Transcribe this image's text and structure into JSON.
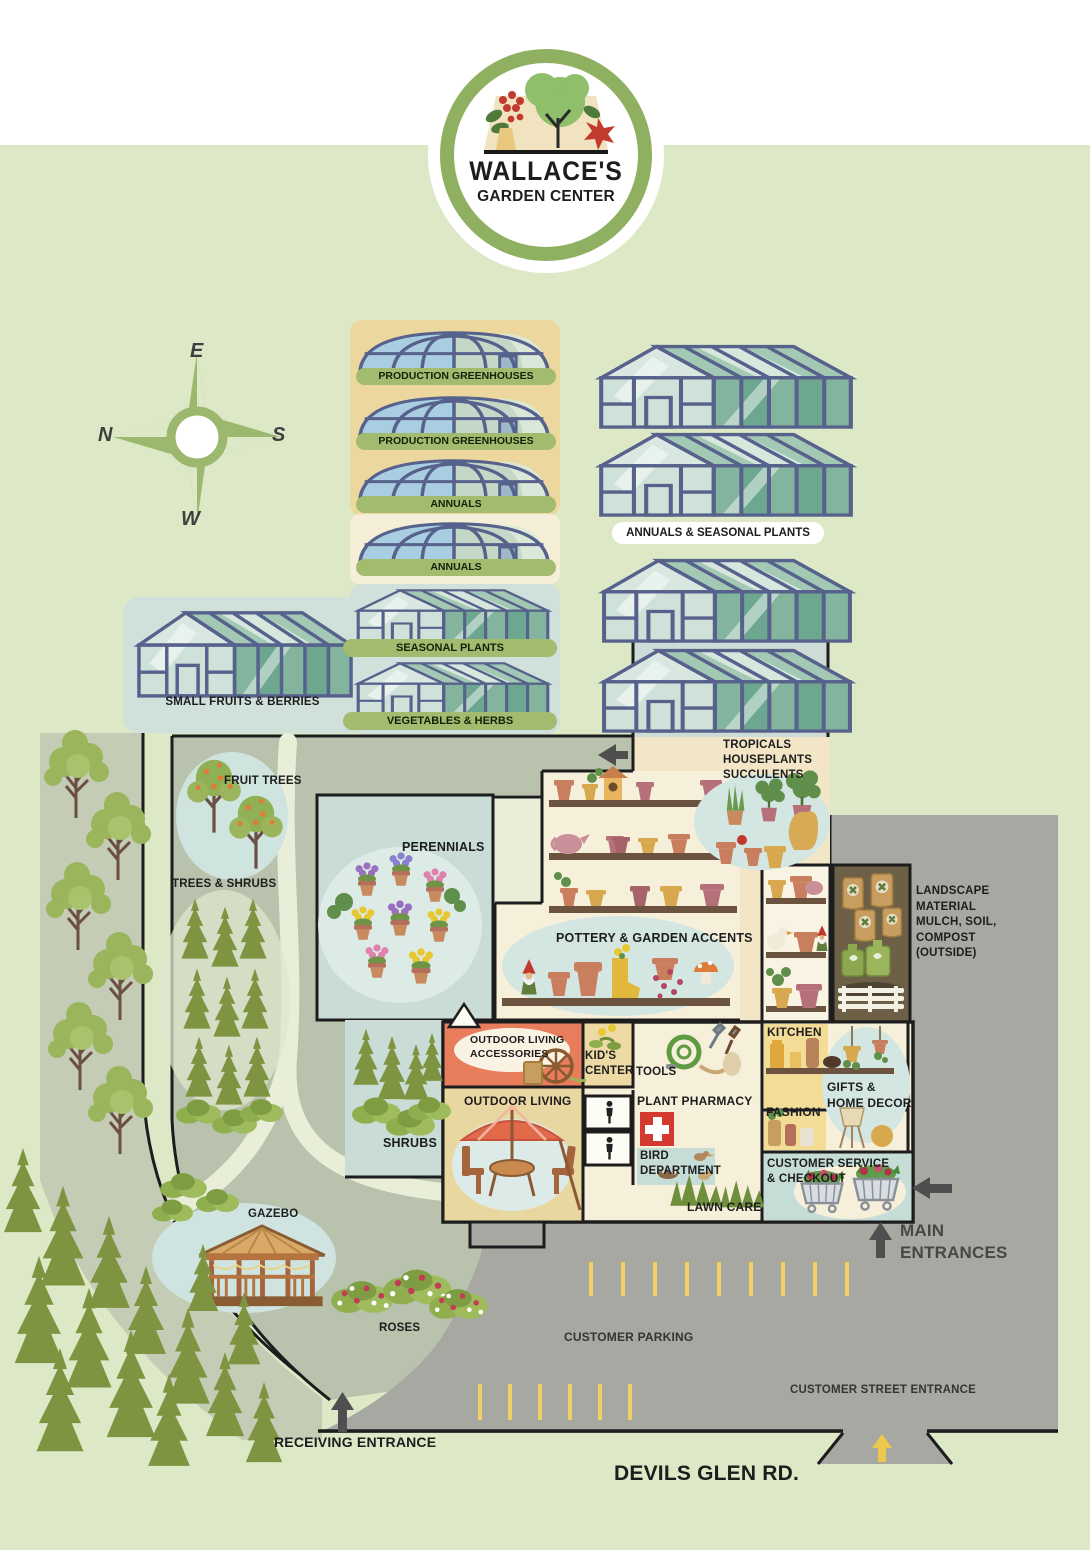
{
  "logo": {
    "line1": "WALLACE'S",
    "line2": "GARDEN CENTER"
  },
  "compass": {
    "top": "E",
    "left": "N",
    "right": "S",
    "bottom": "W"
  },
  "greenhouses": {
    "left_labels": [
      "PRODUCTION GREENHOUSES",
      "PRODUCTION GREENHOUSES",
      "ANNUALS",
      "ANNUALS",
      "SEASONAL PLANTS",
      "VEGETABLES & HERBS"
    ],
    "right_label": "ANNUALS & SEASONAL PLANTS",
    "small_fruits_label": "SMALL FRUITS & BERRIES"
  },
  "outdoor_areas": {
    "fruit_trees": "FRUIT TREES",
    "trees_shrubs": "TREES & SHRUBS",
    "perennials": "PERENNIALS",
    "shrubs": "SHRUBS",
    "gazebo": "GAZEBO",
    "roses": "ROSES",
    "lawn_care": "LAWN CARE"
  },
  "departments": {
    "tropicals": [
      "TROPICALS",
      "HOUSEPLANTS",
      "SUCCULENTS"
    ],
    "pottery": "POTTERY & GARDEN ACCENTS",
    "landscape_material": [
      "LANDSCAPE",
      "MATERIAL",
      "MULCH, SOIL,",
      "COMPOST",
      "(OUTSIDE)"
    ],
    "kitchen": "KITCHEN",
    "gifts_home_decor": [
      "GIFTS &",
      "HOME DECOR"
    ],
    "fashion": "FASHION",
    "customer_service": [
      "CUSTOMER SERVICE",
      "& CHECKOUT"
    ],
    "outdoor_living_accessories": [
      "OUTDOOR LIVING",
      "ACCESSORIES"
    ],
    "kids_center": [
      "KID'S",
      "CENTER"
    ],
    "tools": "TOOLS",
    "outdoor_living": "OUTDOOR LIVING",
    "plant_pharmacy": "PLANT PHARMACY",
    "bird_department": [
      "BIRD",
      "DEPARTMENT"
    ]
  },
  "site": {
    "main_entrances": [
      "MAIN",
      "ENTRANCES"
    ],
    "customer_parking": "CUSTOMER PARKING",
    "customer_street_entrance": "CUSTOMER STREET ENTRANCE",
    "receiving_entrance": "RECEIVING ENTRANCE",
    "road_name": "DEVILS GLEN RD."
  },
  "colors": {
    "background": "#dde9c6",
    "yard": "#b9c2ac",
    "parking": "#a7a8a2",
    "label_pill": "#a2bb6e",
    "greenhouse_frame": "#56618c",
    "walls": "#1d1d1d",
    "orange_room": "#e87d5c",
    "kitchen_yellow": "#f2dc96",
    "mulch_room": "#6e6046",
    "water_blue": "#c9dcd6",
    "parking_stripe": "#efd263",
    "pharmacy_red": "#d4392f",
    "logo_ring": "#8fb061"
  }
}
